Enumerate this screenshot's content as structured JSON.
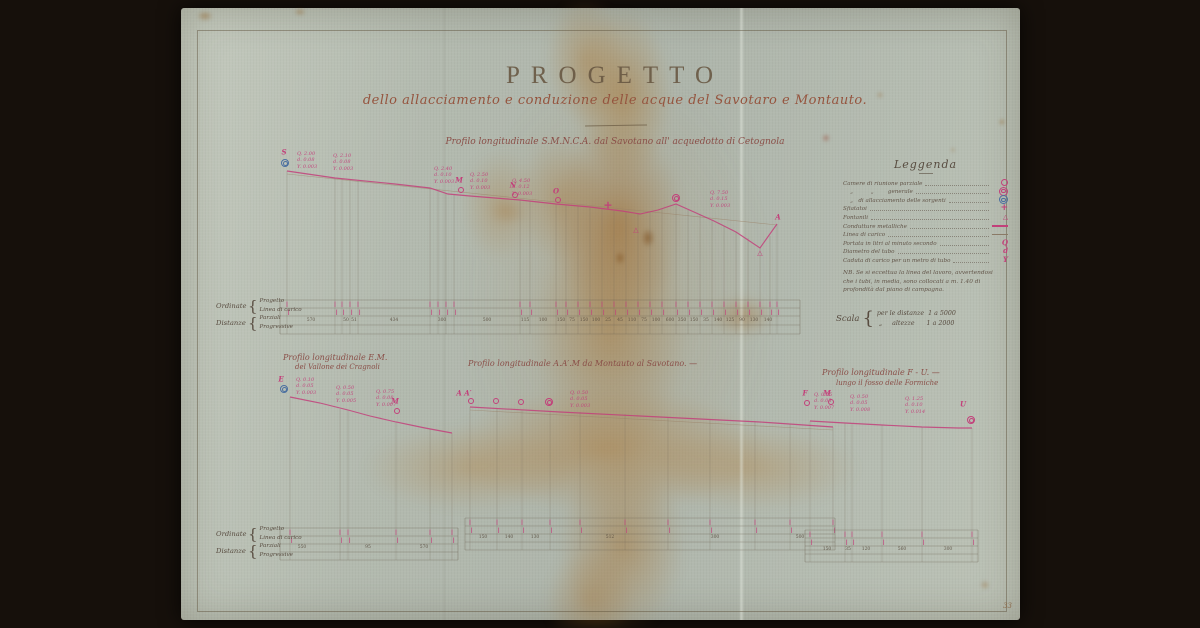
{
  "colors": {
    "accent_pink": "#c2407a",
    "accent_blue": "#4a6fa0",
    "ink": "#5f5244",
    "sheet": "#b4bbb1"
  },
  "title": {
    "main": "PROGETTO",
    "subtitle": "dello allacciamento e conduzione delle acque del Savotaro e Montauto."
  },
  "legend": {
    "title": "Leggenda",
    "items": [
      {
        "label": "Camere di riunione parziale",
        "symbol": "circle"
      },
      {
        "label": "    „          „        generale",
        "symbol": "dcircle"
      },
      {
        "label": "    „   di allacciamento delle sorgenti",
        "symbol": "dcircle-blue"
      },
      {
        "label": "Sfiatatoi",
        "symbol": "cross"
      },
      {
        "label": "Fontanili",
        "symbol": "triangle"
      },
      {
        "label": "Condutture metalliche",
        "symbol": "linepink"
      },
      {
        "label": "Linea di carico",
        "symbol": "linethin"
      },
      {
        "label": "Portata in litri al minuto secondo",
        "symbol": "letter-Q"
      },
      {
        "label": "Diametro del tubo",
        "symbol": "letter-d"
      },
      {
        "label": "Caduta di carico per un metro di tubo",
        "symbol": "letter-Y"
      }
    ],
    "note_lines": [
      "NB. Se si eccettua la linea del lavoro, avvertendosi",
      "che i tubi, in media, sono collocati a m. 1.40 di",
      "profondità dal piano di campagna."
    ]
  },
  "scale": {
    "label": "Scala",
    "rows": "per le distanze  1 a 5000\n „     altezze      1 a 2000"
  },
  "table_labels": {
    "ordinate": "Ordinate",
    "progetto": "Progetto",
    "linea": "Linea di carico",
    "distanze": "Distanze",
    "parziali": "Parziali",
    "progressive": "Progressive"
  },
  "corner_mark": "33",
  "profiles": [
    {
      "title": "Profilo longitudinale S.M.N.C.A. dal Savotano all' acquedotto di Cetognola",
      "line": [
        [
          287,
          171
        ],
        [
          335,
          178
        ],
        [
          395,
          184
        ],
        [
          430,
          188
        ],
        [
          448,
          194
        ],
        [
          470,
          196
        ],
        [
          520,
          200
        ],
        [
          556,
          204
        ],
        [
          590,
          207
        ],
        [
          622,
          211
        ],
        [
          640,
          214
        ],
        [
          658,
          210
        ],
        [
          676,
          204
        ],
        [
          694,
          212
        ],
        [
          714,
          221
        ],
        [
          736,
          232
        ],
        [
          760,
          248
        ],
        [
          777,
          224
        ]
      ],
      "carico": [
        [
          287,
          174
        ],
        [
          777,
          225
        ]
      ],
      "stations": [
        [
          287,
          171
        ],
        [
          335,
          178
        ],
        [
          342,
          179
        ],
        [
          350,
          180
        ],
        [
          358,
          181
        ],
        [
          430,
          188
        ],
        [
          438,
          190
        ],
        [
          446,
          193
        ],
        [
          454,
          195
        ],
        [
          520,
          200
        ],
        [
          530,
          201
        ],
        [
          556,
          204
        ],
        [
          566,
          205
        ],
        [
          578,
          206
        ],
        [
          590,
          207
        ],
        [
          602,
          209
        ],
        [
          614,
          211
        ],
        [
          626,
          212
        ],
        [
          638,
          213
        ],
        [
          650,
          212
        ],
        [
          662,
          209
        ],
        [
          676,
          204
        ],
        [
          688,
          210
        ],
        [
          700,
          214
        ],
        [
          712,
          220
        ],
        [
          724,
          226
        ],
        [
          736,
          232
        ],
        [
          748,
          238
        ],
        [
          760,
          248
        ],
        [
          770,
          236
        ],
        [
          777,
          224
        ]
      ],
      "table": {
        "x1": 280,
        "x2": 800,
        "ys": [
          300,
          308,
          316,
          325,
          334
        ],
        "cells": [
          {
            "x": 311,
            "v": "570"
          },
          {
            "x": 346,
            "v": "50"
          },
          {
            "x": 354,
            "v": "51"
          },
          {
            "x": 394,
            "v": "434"
          },
          {
            "x": 442,
            "v": "300"
          },
          {
            "x": 487,
            "v": "500"
          },
          {
            "x": 525,
            "v": "115"
          },
          {
            "x": 543,
            "v": "100"
          },
          {
            "x": 561,
            "v": "150"
          },
          {
            "x": 572,
            "v": "75"
          },
          {
            "x": 584,
            "v": "150"
          },
          {
            "x": 596,
            "v": "100"
          },
          {
            "x": 608,
            "v": "25"
          },
          {
            "x": 620,
            "v": "45"
          },
          {
            "x": 632,
            "v": "110"
          },
          {
            "x": 644,
            "v": "75"
          },
          {
            "x": 656,
            "v": "100"
          },
          {
            "x": 670,
            "v": "600"
          },
          {
            "x": 682,
            "v": "350"
          },
          {
            "x": 694,
            "v": "150"
          },
          {
            "x": 706,
            "v": "35"
          },
          {
            "x": 718,
            "v": "140"
          },
          {
            "x": 730,
            "v": "125"
          },
          {
            "x": 742,
            "v": "90"
          },
          {
            "x": 754,
            "v": "130"
          },
          {
            "x": 768,
            "v": "140"
          }
        ]
      },
      "annotations": [
        {
          "x": 297,
          "y": 151,
          "lines": [
            "Q. 2.00",
            "d. 0.08",
            "Y. 0.003"
          ]
        },
        {
          "x": 333,
          "y": 153,
          "lines": [
            "Q. 2.10",
            "d. 0.08",
            "Y. 0.003"
          ]
        },
        {
          "x": 434,
          "y": 166,
          "lines": [
            "Q. 2.40",
            "d. 0.10",
            "Y. 0.003"
          ]
        },
        {
          "x": 470,
          "y": 172,
          "lines": [
            "Q. 2.50",
            "d. 0.10",
            "Y. 0.003"
          ]
        },
        {
          "x": 512,
          "y": 178,
          "lines": [
            "Q. 4.50",
            "d. 0.12",
            "Y. 0.003"
          ]
        },
        {
          "x": 710,
          "y": 190,
          "lines": [
            "Q. 7.50",
            "d. 0.15",
            "Y. 0.003"
          ]
        }
      ],
      "markers": [
        {
          "t": "letter",
          "x": 284,
          "y": 152,
          "v": "S"
        },
        {
          "t": "dcircle-blue",
          "x": 285,
          "y": 163
        },
        {
          "t": "letter",
          "x": 459,
          "y": 180,
          "v": "M"
        },
        {
          "t": "circle",
          "x": 461,
          "y": 190
        },
        {
          "t": "letter",
          "x": 513,
          "y": 185,
          "v": "N"
        },
        {
          "t": "circle",
          "x": 515,
          "y": 195
        },
        {
          "t": "letter",
          "x": 556,
          "y": 191,
          "v": "O"
        },
        {
          "t": "circle",
          "x": 558,
          "y": 200
        },
        {
          "t": "cross",
          "x": 608,
          "y": 205
        },
        {
          "t": "triangle",
          "x": 636,
          "y": 230
        },
        {
          "t": "dcircle",
          "x": 676,
          "y": 198
        },
        {
          "t": "triangle",
          "x": 760,
          "y": 253
        },
        {
          "t": "letter",
          "x": 778,
          "y": 217,
          "v": "A"
        }
      ]
    },
    {
      "title": "Profilo longitudinale E.M.",
      "subtitle": "del Vallone dei Cragnoli",
      "line": [
        [
          290,
          397
        ],
        [
          320,
          403
        ],
        [
          348,
          410
        ],
        [
          370,
          416
        ],
        [
          396,
          422
        ],
        [
          425,
          428
        ],
        [
          452,
          433
        ]
      ],
      "stations": [
        [
          290,
          397
        ],
        [
          340,
          409
        ],
        [
          348,
          410
        ],
        [
          396,
          422
        ],
        [
          430,
          429
        ],
        [
          452,
          433
        ]
      ],
      "table": {
        "x1": 280,
        "x2": 458,
        "ys": [
          528,
          536,
          544,
          552,
          560
        ],
        "cells": [
          {
            "x": 302,
            "v": "550"
          },
          {
            "x": 368,
            "v": "95"
          },
          {
            "x": 424,
            "v": "570"
          }
        ]
      },
      "annotations": [
        {
          "x": 296,
          "y": 377,
          "lines": [
            "Q. 0.10",
            "d. 0.05",
            "Y. 0.003"
          ]
        },
        {
          "x": 336,
          "y": 385,
          "lines": [
            "Q. 0.50",
            "d. 0.05",
            "Y. 0.005"
          ]
        },
        {
          "x": 376,
          "y": 389,
          "lines": [
            "Q. 0.75",
            "d. 0.08",
            "Y. 0.007"
          ]
        }
      ],
      "markers": [
        {
          "t": "letter",
          "x": 281,
          "y": 379,
          "v": "E"
        },
        {
          "t": "dcircle-blue",
          "x": 284,
          "y": 389
        },
        {
          "t": "letter",
          "x": 395,
          "y": 401,
          "v": "M"
        },
        {
          "t": "circle",
          "x": 397,
          "y": 411
        }
      ]
    },
    {
      "title": "Profilo longitudinale A.A′.M da Montauto al Savotano. —",
      "line": [
        [
          470,
          407
        ],
        [
          560,
          412
        ],
        [
          660,
          417
        ],
        [
          760,
          422
        ],
        [
          833,
          427
        ]
      ],
      "carico": [
        [
          470,
          410
        ],
        [
          833,
          430
        ]
      ],
      "stations": [
        [
          470,
          407
        ],
        [
          497,
          408
        ],
        [
          522,
          410
        ],
        [
          550,
          411
        ],
        [
          580,
          412
        ],
        [
          625,
          414
        ],
        [
          668,
          417
        ],
        [
          710,
          419
        ],
        [
          755,
          421
        ],
        [
          790,
          424
        ],
        [
          833,
          427
        ]
      ],
      "table": {
        "x1": 465,
        "x2": 835,
        "ys": [
          518,
          526,
          534,
          542,
          550
        ],
        "cells": [
          {
            "x": 483,
            "v": "150"
          },
          {
            "x": 509,
            "v": "140"
          },
          {
            "x": 535,
            "v": "130"
          },
          {
            "x": 610,
            "v": "512"
          },
          {
            "x": 715,
            "v": "300"
          },
          {
            "x": 800,
            "v": "500"
          }
        ]
      },
      "annotations": [
        {
          "x": 570,
          "y": 390,
          "lines": [
            "Q. 0.50",
            "d. 0.05",
            "Y. 0.003"
          ]
        }
      ],
      "markers": [
        {
          "t": "letter",
          "x": 464,
          "y": 393,
          "v": "A A′"
        },
        {
          "t": "circle",
          "x": 471,
          "y": 401
        },
        {
          "t": "circle",
          "x": 496,
          "y": 401
        },
        {
          "t": "circle",
          "x": 521,
          "y": 402
        },
        {
          "t": "dcircle",
          "x": 549,
          "y": 402
        },
        {
          "t": "letter",
          "x": 827,
          "y": 393,
          "v": "M"
        },
        {
          "t": "circle",
          "x": 831,
          "y": 402
        }
      ]
    },
    {
      "title": "Profilo longitudinale F - U. —",
      "subtitle": "lungo il fosso delle Formiche",
      "line": [
        [
          810,
          421
        ],
        [
          845,
          423
        ],
        [
          882,
          425
        ],
        [
          922,
          427
        ],
        [
          958,
          428
        ],
        [
          972,
          428
        ]
      ],
      "stations": [
        [
          810,
          421
        ],
        [
          845,
          423
        ],
        [
          852,
          424
        ],
        [
          882,
          425
        ],
        [
          922,
          427
        ],
        [
          972,
          428
        ]
      ],
      "table": {
        "x1": 805,
        "x2": 978,
        "ys": [
          530,
          538,
          546,
          554,
          562
        ],
        "cells": [
          {
            "x": 827,
            "v": "150"
          },
          {
            "x": 848,
            "v": "35"
          },
          {
            "x": 866,
            "v": "120"
          },
          {
            "x": 902,
            "v": "560"
          },
          {
            "x": 948,
            "v": "300"
          }
        ]
      },
      "annotations": [
        {
          "x": 814,
          "y": 392,
          "lines": [
            "Q. 0.25",
            "d. 0.05",
            "Y. 0.007"
          ]
        },
        {
          "x": 850,
          "y": 394,
          "lines": [
            "Q. 0.50",
            "d. 0.05",
            "Y. 0.008"
          ]
        },
        {
          "x": 905,
          "y": 396,
          "lines": [
            "Q. 1.25",
            "d. 0.10",
            "Y. 0.014"
          ]
        }
      ],
      "markers": [
        {
          "t": "letter",
          "x": 805,
          "y": 393,
          "v": "F"
        },
        {
          "t": "circle",
          "x": 807,
          "y": 403
        },
        {
          "t": "letter",
          "x": 963,
          "y": 404,
          "v": "U"
        },
        {
          "t": "dcircle",
          "x": 971,
          "y": 420
        }
      ]
    }
  ]
}
